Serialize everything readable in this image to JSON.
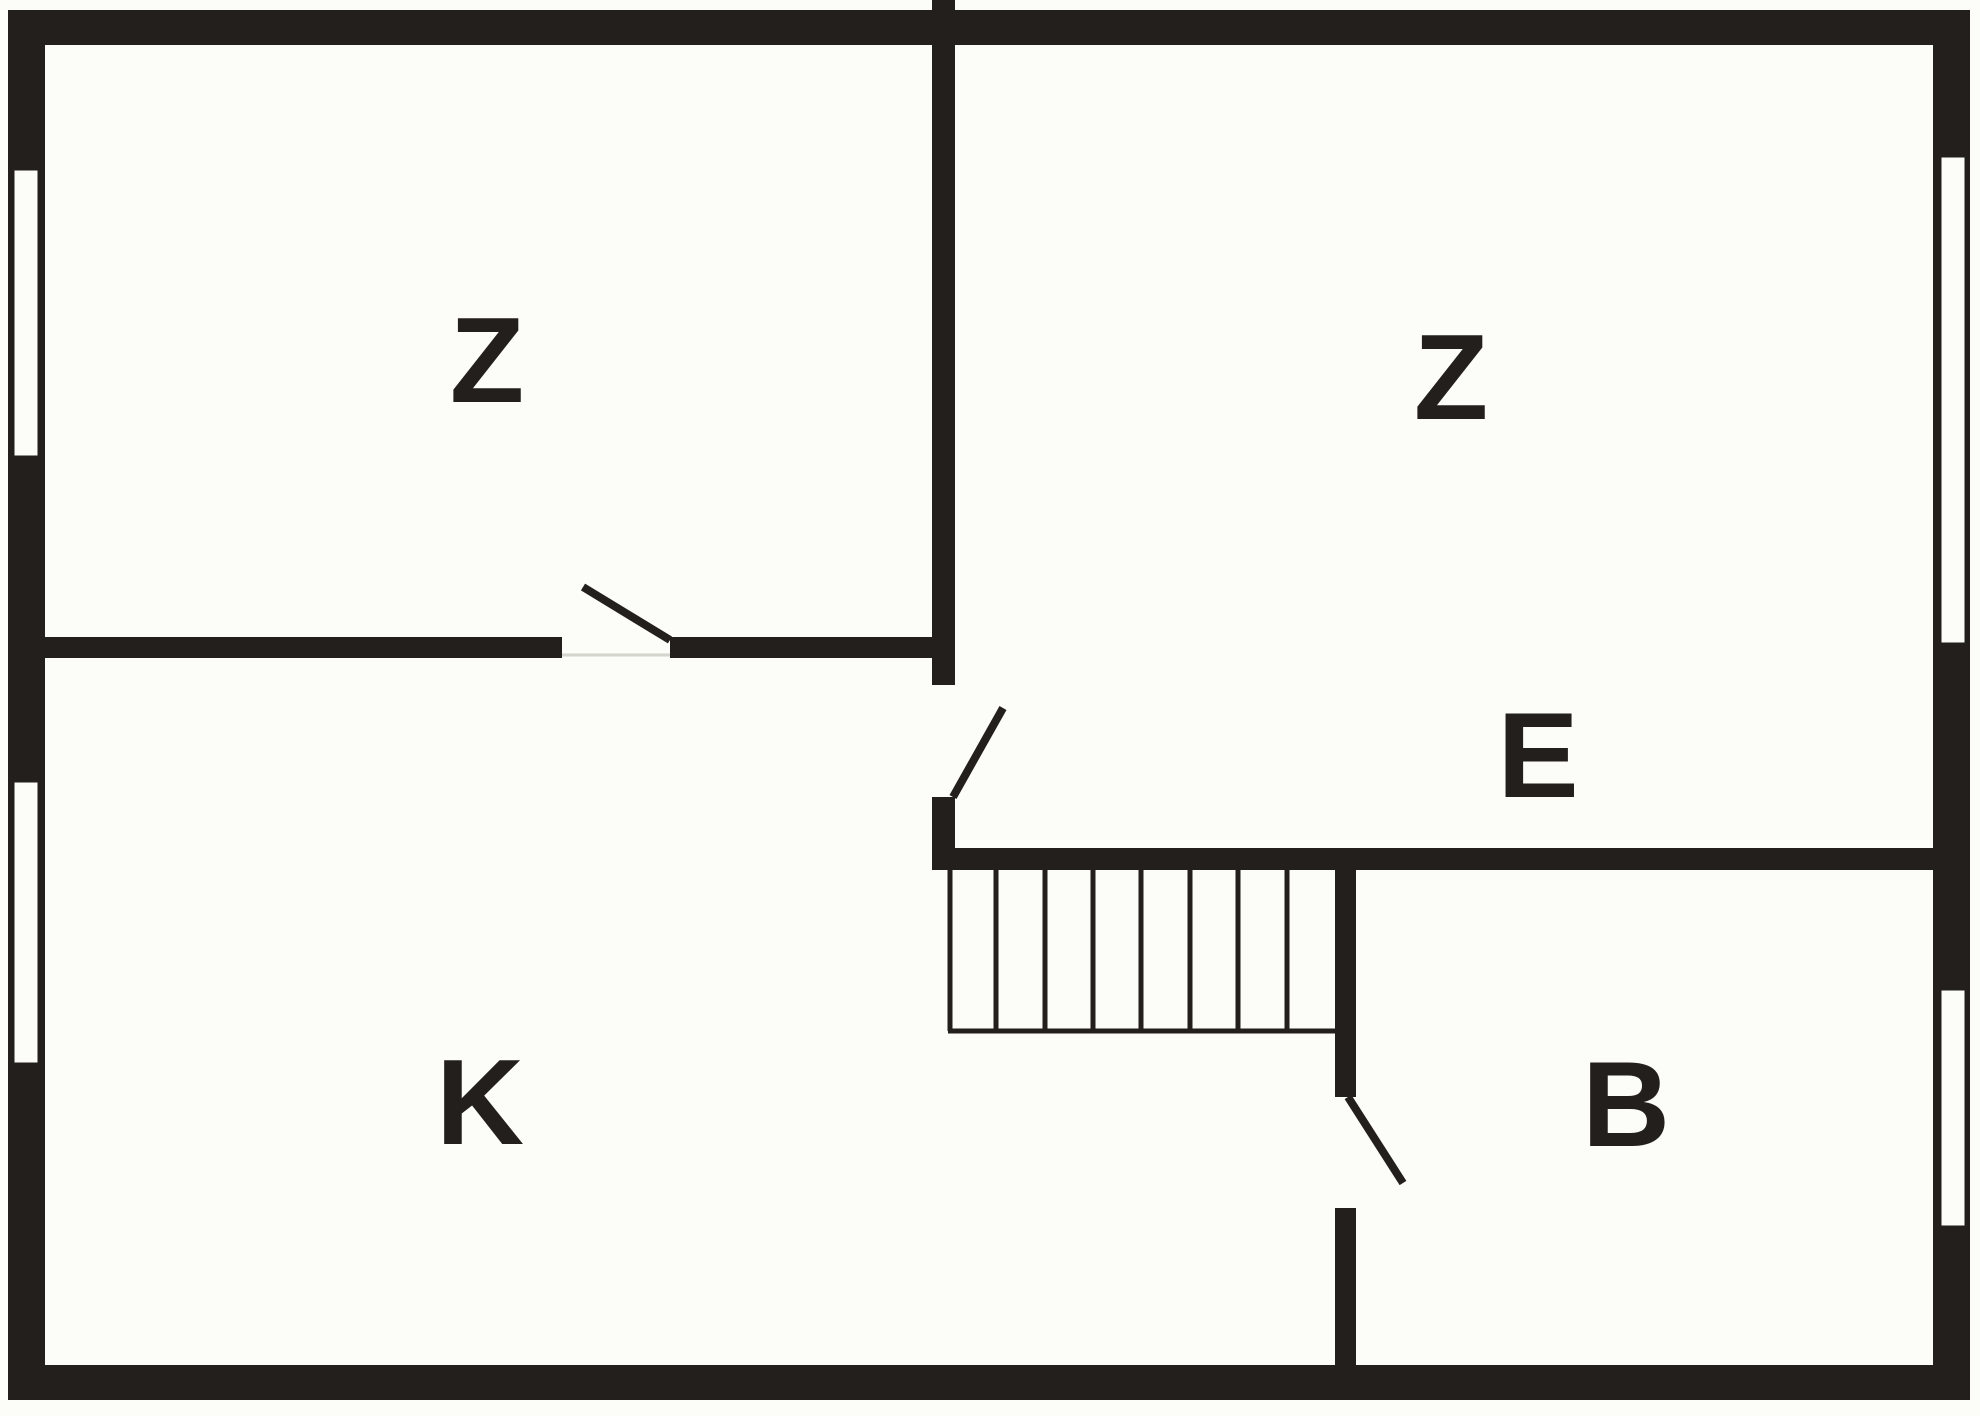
{
  "drawing": {
    "type": "floor-plan",
    "rooms": [
      {
        "label": "Z"
      },
      {
        "label": "Z"
      },
      {
        "label": "E"
      },
      {
        "label": "K"
      },
      {
        "label": "B"
      }
    ],
    "stairs": {
      "treads": 8
    },
    "window_count": 4,
    "door_count": 3,
    "colors": {
      "wall": "#231F1C",
      "paper": "#FCFCF8",
      "threshold_line": "#D5D5CE"
    }
  }
}
